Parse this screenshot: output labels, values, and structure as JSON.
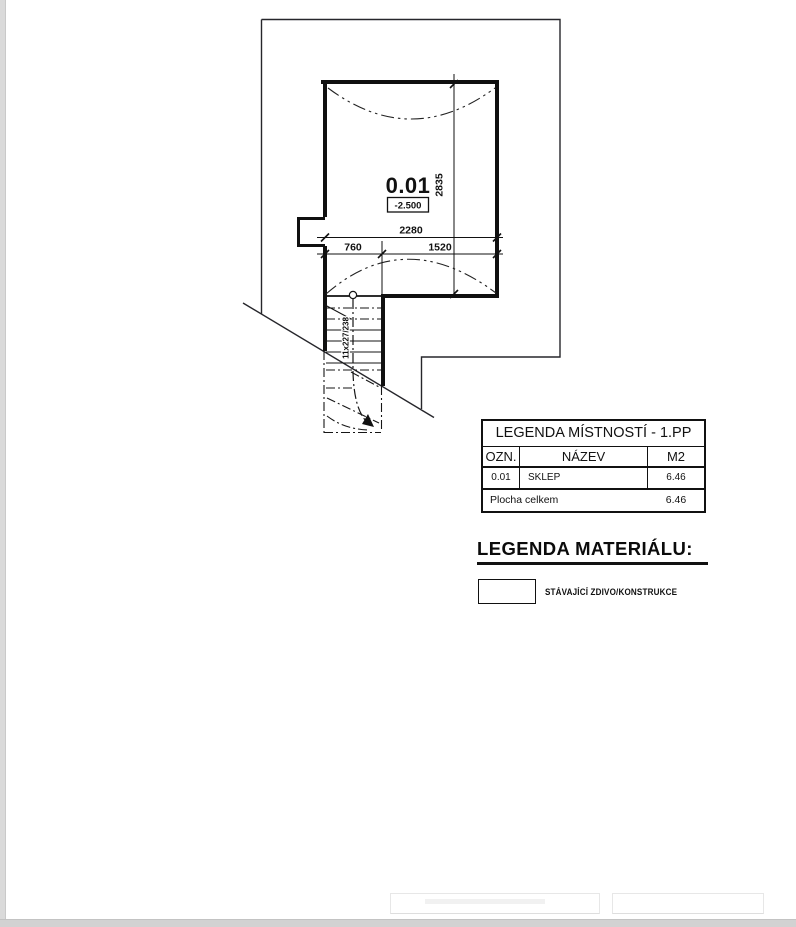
{
  "plan": {
    "room_number": "0.01",
    "room_elevation": "-2.500",
    "dim_total_width": "2280",
    "dim_left_width": "760",
    "dim_right_width": "1520",
    "dim_height": "2835",
    "stair_label": "11x227/238"
  },
  "room_legend": {
    "title": "LEGENDA MÍSTNOSTÍ - 1.PP",
    "columns": [
      "OZN.",
      "NÁZEV",
      "M2"
    ],
    "rows": [
      [
        "0.01",
        "SKLEP",
        "6.46"
      ]
    ],
    "footer_label": "Plocha celkem",
    "footer_value": "6.46"
  },
  "material_legend": {
    "title": "LEGENDA MATERIÁLU:",
    "items": [
      {
        "label": "STÁVAJÍCÍ ZDIVO/KONSTRUKCE"
      }
    ]
  }
}
